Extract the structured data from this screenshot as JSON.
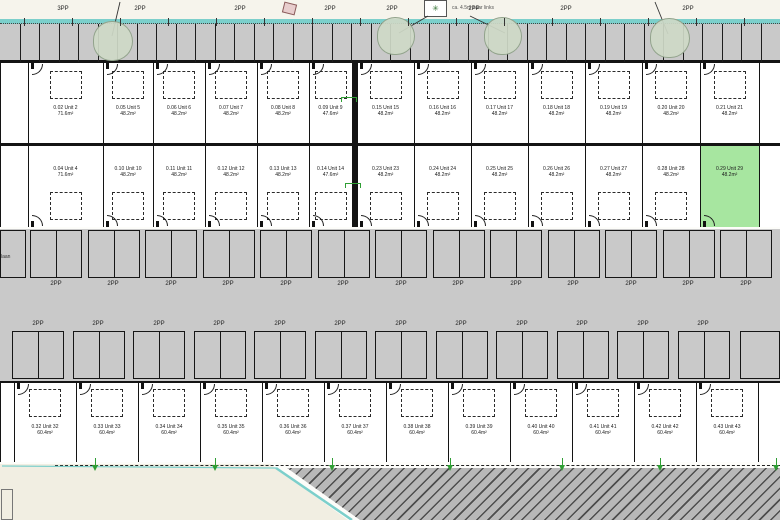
{
  "plan": {
    "type": "site-plan",
    "highlight_color": "#a7e6a0"
  },
  "colors": {
    "parking_fill": "#c9c9c9",
    "unit_fill": "#ffffff",
    "highlight": "#a7e6a0",
    "teal": "#7ccfcb",
    "beige": "#f1eee2",
    "wall": "#141414",
    "green_marker": "#2f9e34",
    "tree_fill": "rgba(206,217,199,0.92)",
    "pink": "#e8cdcd"
  },
  "top_annotations": {
    "note": "ca. 4.5m naar links",
    "tree_symbol": "✳",
    "top_labels": [
      {
        "x": 63,
        "t": "3PP"
      },
      {
        "x": 140,
        "t": "2PP"
      },
      {
        "x": 240,
        "t": "2PP"
      },
      {
        "x": 330,
        "t": "2PP"
      },
      {
        "x": 392,
        "t": "2PP"
      },
      {
        "x": 474,
        "t": "2PP"
      },
      {
        "x": 566,
        "t": "2PP"
      },
      {
        "x": 688,
        "t": "2PP"
      }
    ]
  },
  "street_label": "laan",
  "gebouw_a": {
    "label": "Gebouw A",
    "row1_units": [
      {
        "x": 0,
        "w": 28,
        "code": "",
        "area": ""
      },
      {
        "x": 28,
        "w": 75,
        "code": "0.02 Unit 2",
        "area": "71.6m²"
      },
      {
        "x": 103,
        "w": 50,
        "code": "0.05 Unit 5",
        "area": "48.2m²"
      },
      {
        "x": 153,
        "w": 52,
        "code": "0.06 Unit 6",
        "area": "48.2m²"
      },
      {
        "x": 205,
        "w": 52,
        "code": "0.07 Unit 7",
        "area": "48.2m²"
      },
      {
        "x": 257,
        "w": 52,
        "code": "0.08 Unit 8",
        "area": "48.2m²"
      },
      {
        "x": 309,
        "w": 43,
        "code": "0.09 Unit 9",
        "area": "47.6m²"
      },
      {
        "x": 357,
        "w": 57,
        "code": "0.15 Unit 15",
        "area": "48.2m²"
      },
      {
        "x": 414,
        "w": 57,
        "code": "0.16 Unit 16",
        "area": "48.2m²"
      },
      {
        "x": 471,
        "w": 57,
        "code": "0.17 Unit 17",
        "area": "48.2m²"
      },
      {
        "x": 528,
        "w": 57,
        "code": "0.18 Unit 18",
        "area": "48.2m²"
      },
      {
        "x": 585,
        "w": 57,
        "code": "0.19 Unit 19",
        "area": "48.2m²"
      },
      {
        "x": 642,
        "w": 58,
        "code": "0.20 Unit 20",
        "area": "48.2m²"
      },
      {
        "x": 700,
        "w": 59,
        "code": "0.21 Unit 21",
        "area": "48.2m²"
      },
      {
        "x": 759,
        "w": 21,
        "code": "",
        "area": ""
      }
    ],
    "row2_units": [
      {
        "x": 0,
        "w": 28,
        "code": "",
        "area": ""
      },
      {
        "x": 28,
        "w": 75,
        "code": "0.04 Unit 4",
        "area": "71.6m²"
      },
      {
        "x": 103,
        "w": 50,
        "code": "0.10 Unit 10",
        "area": "48.2m²"
      },
      {
        "x": 153,
        "w": 52,
        "code": "0.11 Unit 11",
        "area": "48.2m²"
      },
      {
        "x": 205,
        "w": 52,
        "code": "0.12 Unit 12",
        "area": "48.2m²"
      },
      {
        "x": 257,
        "w": 52,
        "code": "0.13 Unit 13",
        "area": "48.2m²"
      },
      {
        "x": 309,
        "w": 43,
        "code": "0.14 Unit 14",
        "area": "47.6m²"
      },
      {
        "x": 357,
        "w": 57,
        "code": "0.23 Unit 23",
        "area": "48.2m²"
      },
      {
        "x": 414,
        "w": 57,
        "code": "0.24 Unit 24",
        "area": "48.2m²"
      },
      {
        "x": 471,
        "w": 57,
        "code": "0.25 Unit 25",
        "area": "48.2m²"
      },
      {
        "x": 528,
        "w": 57,
        "code": "0.26 Unit 26",
        "area": "48.2m²"
      },
      {
        "x": 585,
        "w": 57,
        "code": "0.27 Unit 27",
        "area": "48.2m²"
      },
      {
        "x": 642,
        "w": 58,
        "code": "0.28 Unit 28",
        "area": "48.2m²"
      },
      {
        "x": 700,
        "w": 59,
        "code": "0.29 Unit 29",
        "area": "48.2m²",
        "highlight": true
      },
      {
        "x": 759,
        "w": 21,
        "code": "",
        "area": ""
      }
    ]
  },
  "gebouw_b": {
    "label": "Gebouw B",
    "zone_note": "categorie 4.1",
    "units": [
      {
        "x": 0,
        "w": 14,
        "code": "",
        "area": ""
      },
      {
        "x": 14,
        "w": 62,
        "code": "0.32 Unit 32",
        "area": "60.4m²"
      },
      {
        "x": 76,
        "w": 62,
        "code": "0.33 Unit 33",
        "area": "60.4m²"
      },
      {
        "x": 138,
        "w": 62,
        "code": "0.34 Unit 34",
        "area": "60.4m²"
      },
      {
        "x": 200,
        "w": 62,
        "code": "0.35 Unit 35",
        "area": "60.4m²"
      },
      {
        "x": 262,
        "w": 62,
        "code": "0.36 Unit 36",
        "area": "60.4m²"
      },
      {
        "x": 324,
        "w": 62,
        "code": "0.37 Unit 37",
        "area": "60.4m²"
      },
      {
        "x": 386,
        "w": 62,
        "code": "0.38 Unit 38",
        "area": "60.4m²"
      },
      {
        "x": 448,
        "w": 62,
        "code": "0.39 Unit 39",
        "area": "60.4m²"
      },
      {
        "x": 510,
        "w": 62,
        "code": "0.40 Unit 40",
        "area": "60.4m²"
      },
      {
        "x": 572,
        "w": 62,
        "code": "0.41 Unit 41",
        "area": "60.4m²"
      },
      {
        "x": 634,
        "w": 62,
        "code": "0.42 Unit 42",
        "area": "60.4m²"
      },
      {
        "x": 696,
        "w": 62,
        "code": "0.43 Unit 43",
        "area": "60.4m²"
      },
      {
        "x": 758,
        "w": 22,
        "code": "",
        "area": ""
      }
    ]
  },
  "parking": {
    "bay_label": "2PP",
    "mid_row_labels": [
      {
        "x": 56,
        "t": "2PP"
      },
      {
        "x": 113,
        "t": "2PP"
      },
      {
        "x": 171,
        "t": "2PP"
      },
      {
        "x": 228,
        "t": "2PP"
      },
      {
        "x": 286,
        "t": "2PP"
      },
      {
        "x": 343,
        "t": "2PP"
      },
      {
        "x": 401,
        "t": "2PP"
      },
      {
        "x": 458,
        "t": "2PP"
      },
      {
        "x": 516,
        "t": "2PP"
      },
      {
        "x": 573,
        "t": "2PP"
      },
      {
        "x": 631,
        "t": "2PP"
      },
      {
        "x": 688,
        "t": "2PP"
      },
      {
        "x": 746,
        "t": "2PP"
      }
    ],
    "lower_row_labels": [
      {
        "x": 38,
        "t": "2PP"
      },
      {
        "x": 98,
        "t": "2PP"
      },
      {
        "x": 159,
        "t": "2PP"
      },
      {
        "x": 219,
        "t": "2PP"
      },
      {
        "x": 280,
        "t": "2PP"
      },
      {
        "x": 340,
        "t": "2PP"
      },
      {
        "x": 401,
        "t": "2PP"
      },
      {
        "x": 461,
        "t": "2PP"
      },
      {
        "x": 522,
        "t": "2PP"
      },
      {
        "x": 582,
        "t": "2PP"
      },
      {
        "x": 643,
        "t": "2PP"
      },
      {
        "x": 703,
        "t": "2PP"
      }
    ]
  },
  "landscape": {
    "trees": [
      {
        "x": 113,
        "y": 41,
        "r": 20
      },
      {
        "x": 396,
        "y": 36,
        "r": 19
      },
      {
        "x": 503,
        "y": 36,
        "r": 19
      },
      {
        "x": 670,
        "y": 38,
        "r": 20
      }
    ],
    "green_arrow_xs": [
      95,
      215,
      332,
      450,
      562,
      660,
      776
    ],
    "dimension_markers": [
      {
        "x": 341,
        "y": 97
      },
      {
        "x": 345,
        "y": 183
      }
    ]
  }
}
